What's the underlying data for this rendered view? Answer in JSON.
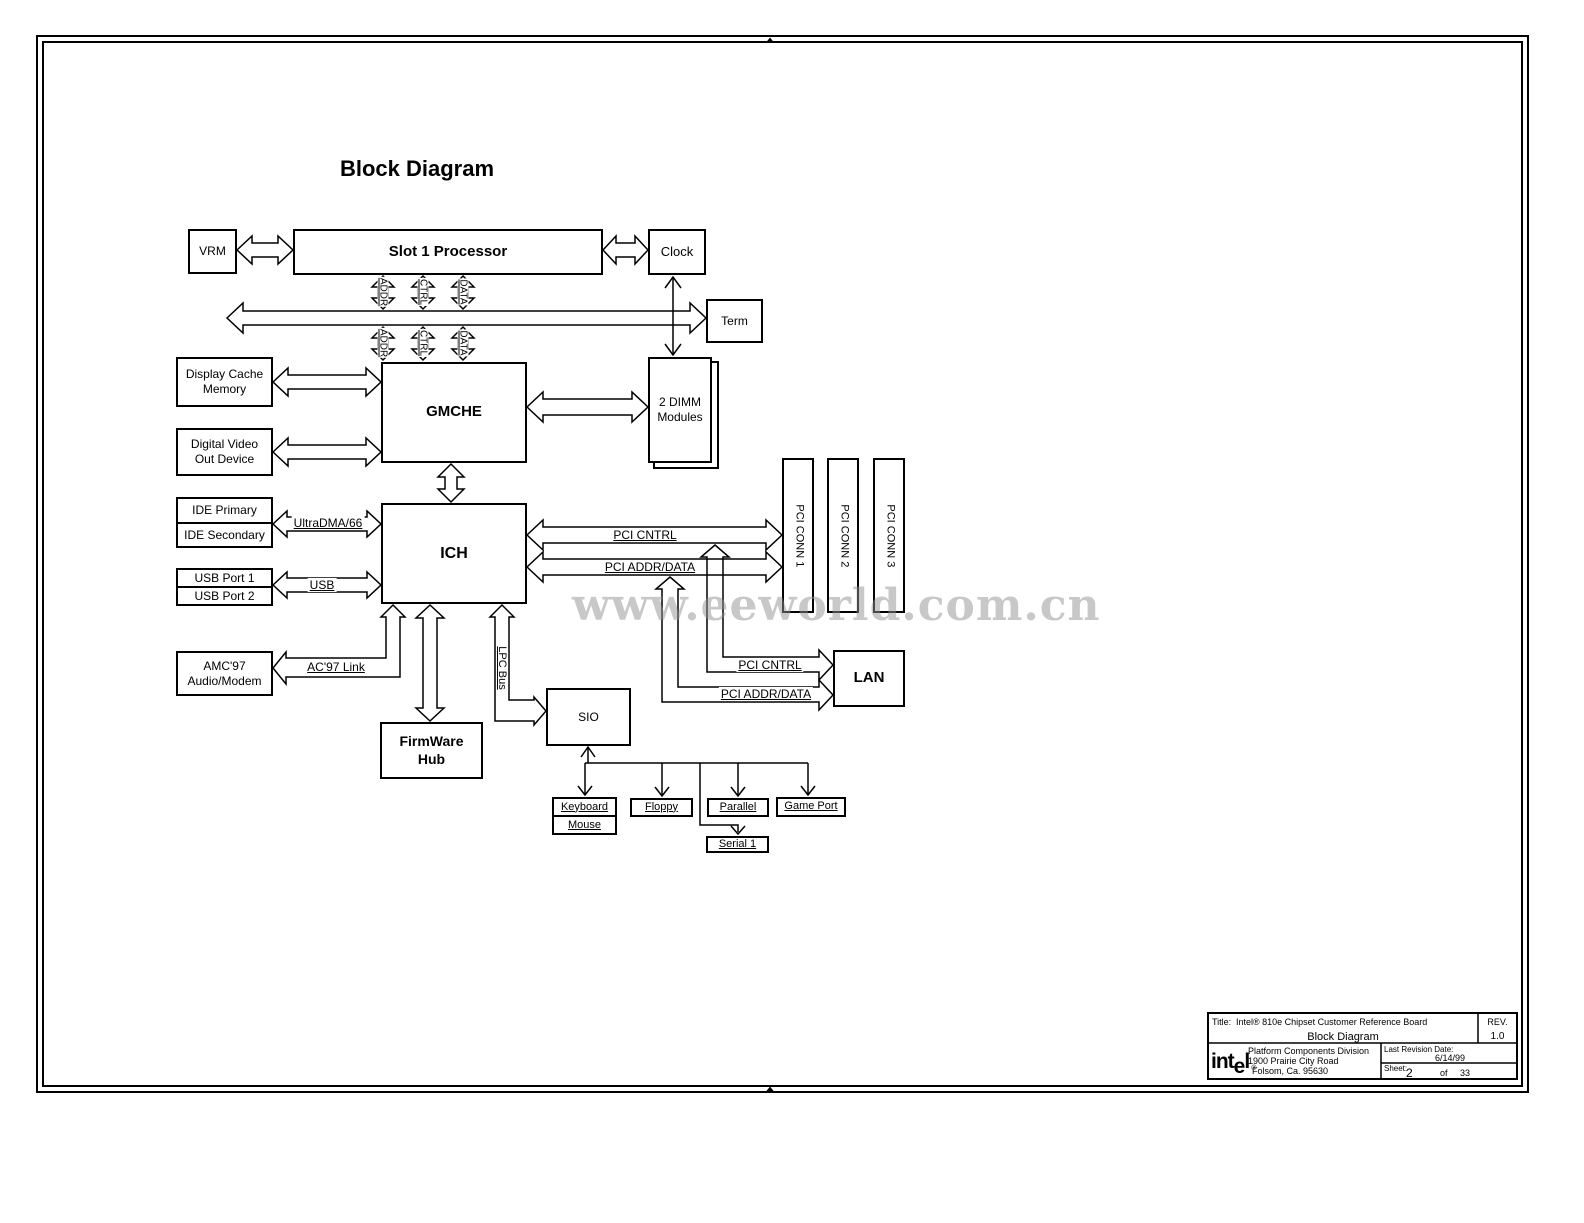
{
  "colors": {
    "line": "#000000",
    "background": "#ffffff",
    "watermark_gray": "#919191"
  },
  "heading": "Block Diagram",
  "watermark": "www.eeworld.com.cn",
  "boxes": {
    "vrm": "VRM",
    "slot1": "Slot 1 Processor",
    "clock": "Clock",
    "term": "Term",
    "display_cache_1": "Display Cache",
    "display_cache_2": "Memory",
    "dvo_1": "Digital Video",
    "dvo_2": "Out Device",
    "gmche": "GMCHE",
    "dimm_1": "2 DIMM",
    "dimm_2": "Modules",
    "ide_primary": "IDE Primary",
    "ide_secondary": "IDE Secondary",
    "usb_port1": "USB Port 1",
    "usb_port2": "USB Port 2",
    "ich": "ICH",
    "pci_conn1": "PCI CONN 1",
    "pci_conn2": "PCI CONN 2",
    "pci_conn3": "PCI CONN 3",
    "amc_1": "AMC'97",
    "amc_2": "Audio/Modem",
    "firmware_1": "FirmWare",
    "firmware_2": "Hub",
    "sio": "SIO",
    "lan": "LAN",
    "keyboard": "Keyboard",
    "mouse": "Mouse",
    "floppy": "Floppy",
    "parallel": "Parallel",
    "game_port": "Game Port",
    "serial1": "Serial 1"
  },
  "nets": {
    "addr": "ADDR",
    "ctrl": "CTRL",
    "data": "DATA",
    "ultradma": "UltraDMA/66",
    "usb": "USB",
    "pci_cntrl": "PCI CNTRL",
    "pci_addr_data": "PCI ADDR/DATA",
    "ac97_link": "AC'97 Link",
    "lpc_bus": "LPC Bus"
  },
  "title_block": {
    "title_label": "Title:",
    "title": "Intel® 810e Chipset Customer Reference Board",
    "subtitle": "Block Diagram",
    "rev_label": "REV.",
    "rev": "1.0",
    "company_pre": "int",
    "company_e": "e",
    "company_post": "l",
    "company_reg": "®",
    "division": "Platform Components Division",
    "address1": "1900 Prairie City Road",
    "address2": "Folsom, Ca. 95630",
    "last_revision_label": "Last Revision Date:",
    "last_revision": "6/14/99",
    "sheet_label": "Sheet:",
    "sheet_number": "2",
    "sheet_of": "of",
    "sheet_total": "33"
  }
}
